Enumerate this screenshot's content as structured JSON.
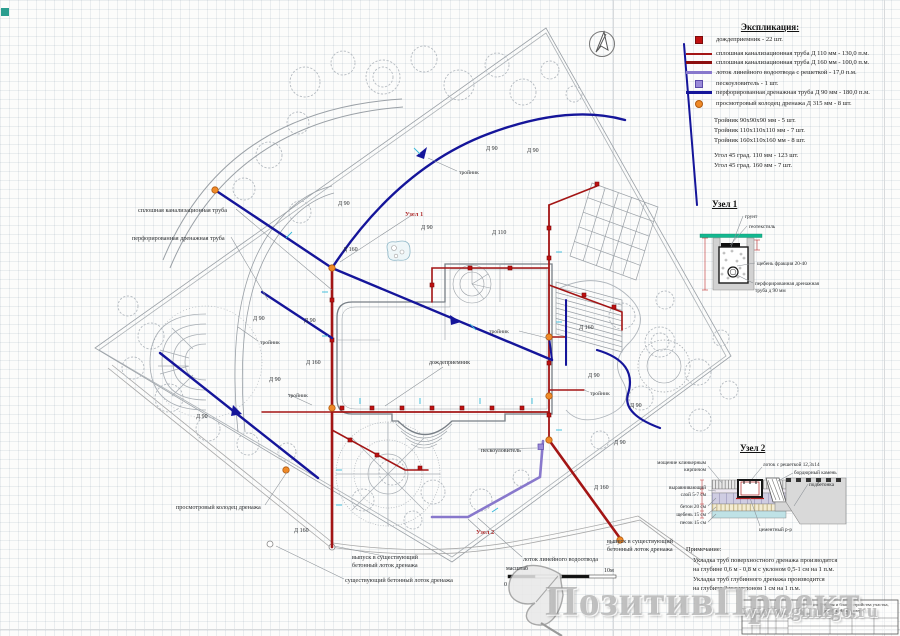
{
  "legend": {
    "title": "Экспликация:",
    "items": [
      {
        "symbol": "red-square",
        "label": "дождеприемник - 22 шт."
      },
      {
        "symbol": "red-line-thin",
        "label": "сплошная канализационная труба Д 110 мм - 130,0 п.м."
      },
      {
        "symbol": "red-line-thick",
        "label": "сплошная канализационная труба Д 160 мм - 100,0  п.м."
      },
      {
        "symbol": "purple-line",
        "label": "лоток линейного водоотвода с решеткой - 17,0 п.м."
      },
      {
        "symbol": "purple-square",
        "label": "пескоуловитель - 1 шт."
      },
      {
        "symbol": "blue-line",
        "label": "перфорированная дренажная труба Д 90 мм - 180,0 п.м."
      },
      {
        "symbol": "orange-circle",
        "label": "просмотровый колодец дренажа Д 315 мм - 8 шт."
      }
    ],
    "fittings": [
      "Тройник 90х90х90 мм - 5 шт.",
      "Тройник 110х110х110 мм - 7 шт.",
      "Тройник 160х110х160 мм - 8 шт."
    ],
    "angles": [
      "Угол 45 град. 110 мм - 123 шт.",
      "Угол 45 град. 160 мм - 7 шт."
    ]
  },
  "node1": {
    "title": "Узел 1"
  },
  "node2": {
    "title": "Узел 2"
  },
  "note": {
    "title": "Примечание:",
    "lines": [
      "Укладка труб поверхностного дренажа производится",
      "на глубине 0,6 м - 0,8 м с уклоном 0,5-1 см на 1 п.м.",
      "Укладка труб глубинного дренажа производится",
      "на глубине 2 м с уклоном 1 см на 1 п.м."
    ]
  },
  "titleblock": {
    "line1": "Проект озеленения и благоустройства участка,",
    "line2": "поселок Новые озера"
  },
  "watermark": {
    "text": "ПозитивПроект",
    "url": "www.ginkgo.ru"
  },
  "scalebar": {
    "label": "масштаб",
    "start": "0",
    "end": "10м"
  },
  "colors": {
    "sewer_pipe": "#a31515",
    "drain_pipe": "#15159a",
    "linear_drain": "#8878cc",
    "drain_well": "#f08a28",
    "rain_inlet": "#c01010",
    "grass": "#14b890"
  },
  "svg_labels": [
    {
      "t": "Д 90",
      "x": 486,
      "y": 150,
      "n": "pipe-diameter-label"
    },
    {
      "t": "Д 90",
      "x": 527,
      "y": 152,
      "n": "pipe-diameter-label"
    },
    {
      "t": "Д 90",
      "x": 338,
      "y": 205,
      "n": "pipe-diameter-label"
    },
    {
      "t": "Д 90",
      "x": 421,
      "y": 229,
      "n": "pipe-diameter-label"
    },
    {
      "t": "Д 110",
      "x": 492,
      "y": 234,
      "n": "pipe-diameter-label"
    },
    {
      "t": "Д 160",
      "x": 343,
      "y": 251,
      "n": "pipe-diameter-label"
    },
    {
      "t": "Д 90",
      "x": 253,
      "y": 320,
      "n": "pipe-diameter-label"
    },
    {
      "t": "Д 90",
      "x": 304,
      "y": 322,
      "n": "pipe-diameter-label"
    },
    {
      "t": "Д 160",
      "x": 306,
      "y": 364,
      "n": "pipe-diameter-label"
    },
    {
      "t": "Д 90",
      "x": 269,
      "y": 381,
      "n": "pipe-diameter-label"
    },
    {
      "t": "Д 90",
      "x": 196,
      "y": 418,
      "n": "pipe-diameter-label"
    },
    {
      "t": "Д 90",
      "x": 614,
      "y": 444,
      "n": "pipe-diameter-label"
    },
    {
      "t": "Д 160",
      "x": 579,
      "y": 329,
      "n": "pipe-diameter-label"
    },
    {
      "t": "Д 90",
      "x": 588,
      "y": 377,
      "n": "pipe-diameter-label"
    },
    {
      "t": "Д 90",
      "x": 630,
      "y": 407,
      "n": "pipe-diameter-label"
    },
    {
      "t": "Д 160",
      "x": 294,
      "y": 532,
      "n": "pipe-diameter-label"
    },
    {
      "t": "Д 160",
      "x": 594,
      "y": 489,
      "n": "pipe-diameter-label"
    },
    {
      "t": "тройник",
      "x": 459,
      "y": 174,
      "s": 5.6,
      "n": "tee-label"
    },
    {
      "t": "тройник",
      "x": 260,
      "y": 344,
      "s": 5.6,
      "n": "tee-label"
    },
    {
      "t": "тройник",
      "x": 288,
      "y": 397,
      "s": 5.6,
      "n": "tee-label"
    },
    {
      "t": "тройник",
      "x": 489,
      "y": 333,
      "s": 5.6,
      "n": "tee-label"
    },
    {
      "t": "тройник",
      "x": 590,
      "y": 395,
      "s": 5.6,
      "n": "tee-label"
    },
    {
      "t": "дождеприемник",
      "x": 429,
      "y": 364,
      "n": "rain-inlet-label"
    },
    {
      "t": "пескоуловитель",
      "x": 481,
      "y": 452,
      "n": "sand-trap-label"
    },
    {
      "t": "Узел 1",
      "x": 405,
      "y": 216,
      "s": 6.5,
      "c": "#b03030",
      "b": 1,
      "n": "node1-marker-label"
    },
    {
      "t": "Узел 2",
      "x": 476,
      "y": 534,
      "s": 6.5,
      "c": "#b03030",
      "b": 1,
      "n": "node2-marker-label"
    },
    {
      "t": "сплошная канализационная труба",
      "x": 138,
      "y": 212,
      "s": 6.2,
      "n": "callout-label"
    },
    {
      "t": "перфорированная дренажная труба",
      "x": 132,
      "y": 240,
      "s": 6.2,
      "n": "callout-label"
    },
    {
      "t": "просмотровый колодец дренажа",
      "x": 176,
      "y": 509,
      "s": 6.2,
      "n": "callout-label"
    },
    {
      "t": "выпуск в существующий",
      "x": 352,
      "y": 559,
      "s": 6.2,
      "n": "callout-label"
    },
    {
      "t": "бетонный лоток дренажа",
      "x": 352,
      "y": 567,
      "s": 6.2,
      "n": "callout-label"
    },
    {
      "t": "существующий бетонный лоток дренажа",
      "x": 345,
      "y": 582,
      "s": 6.2,
      "n": "callout-label"
    },
    {
      "t": "лоток линейного водоотвода",
      "x": 523,
      "y": 561,
      "s": 6.2,
      "n": "callout-label"
    },
    {
      "t": "выпуск в существующий",
      "x": 607,
      "y": 543,
      "s": 6.2,
      "n": "callout-label"
    },
    {
      "t": "бетонный лоток дренажа",
      "x": 607,
      "y": 551,
      "s": 6.2,
      "n": "callout-label"
    },
    {
      "t": "масштаб",
      "x": 506,
      "y": 570,
      "s": 6,
      "n": "scale-label"
    },
    {
      "t": "0",
      "x": 504,
      "y": 586,
      "s": 6,
      "n": "scale-tick-label"
    },
    {
      "t": "10м",
      "x": 604,
      "y": 572,
      "s": 6,
      "n": "scale-tick-label"
    },
    {
      "t": "грунт",
      "x": 745,
      "y": 218,
      "s": 5.2,
      "n": "node1-label"
    },
    {
      "t": "геотекстиль",
      "x": 749,
      "y": 228,
      "s": 5.2,
      "n": "node1-label"
    },
    {
      "t": "щебень фракция 20-40",
      "x": 757,
      "y": 265,
      "s": 5.2,
      "n": "node1-label"
    },
    {
      "t": "перфорированная дренажная",
      "x": 755,
      "y": 285,
      "s": 5.2,
      "n": "node1-label"
    },
    {
      "t": "труба д 90 мм",
      "x": 755,
      "y": 292,
      "s": 5.2,
      "n": "node1-label"
    },
    {
      "t": "лоток с решеткой 12,3х14",
      "x": 763,
      "y": 466,
      "s": 5.2,
      "n": "node2-label"
    },
    {
      "t": "бордюрный камень",
      "x": 794,
      "y": 474,
      "s": 5.2,
      "n": "node2-label"
    },
    {
      "t": "подбетонка",
      "x": 809,
      "y": 486,
      "s": 5.2,
      "n": "node2-label"
    },
    {
      "t": "цементный р-р",
      "x": 759,
      "y": 531,
      "s": 5.2,
      "n": "node2-label"
    },
    {
      "t": "мощение клинкерным",
      "x": 706,
      "y": 464,
      "s": 5.2,
      "a": "e",
      "n": "node2-label"
    },
    {
      "t": "кирпичом",
      "x": 706,
      "y": 471,
      "s": 5.2,
      "a": "e",
      "n": "node2-label"
    },
    {
      "t": "выравнивающий",
      "x": 706,
      "y": 489,
      "s": 5.2,
      "a": "e",
      "n": "node2-label"
    },
    {
      "t": "слой 5-7 см",
      "x": 706,
      "y": 496,
      "s": 5.2,
      "a": "e",
      "n": "node2-label"
    },
    {
      "t": "бетон 20 см",
      "x": 706,
      "y": 508,
      "s": 5.2,
      "a": "e",
      "n": "node2-label"
    },
    {
      "t": "щебень 15 см",
      "x": 706,
      "y": 516,
      "s": 5.2,
      "a": "e",
      "n": "node2-label"
    },
    {
      "t": "песок 15 см",
      "x": 706,
      "y": 524,
      "s": 5.2,
      "a": "e",
      "n": "node2-label"
    }
  ]
}
